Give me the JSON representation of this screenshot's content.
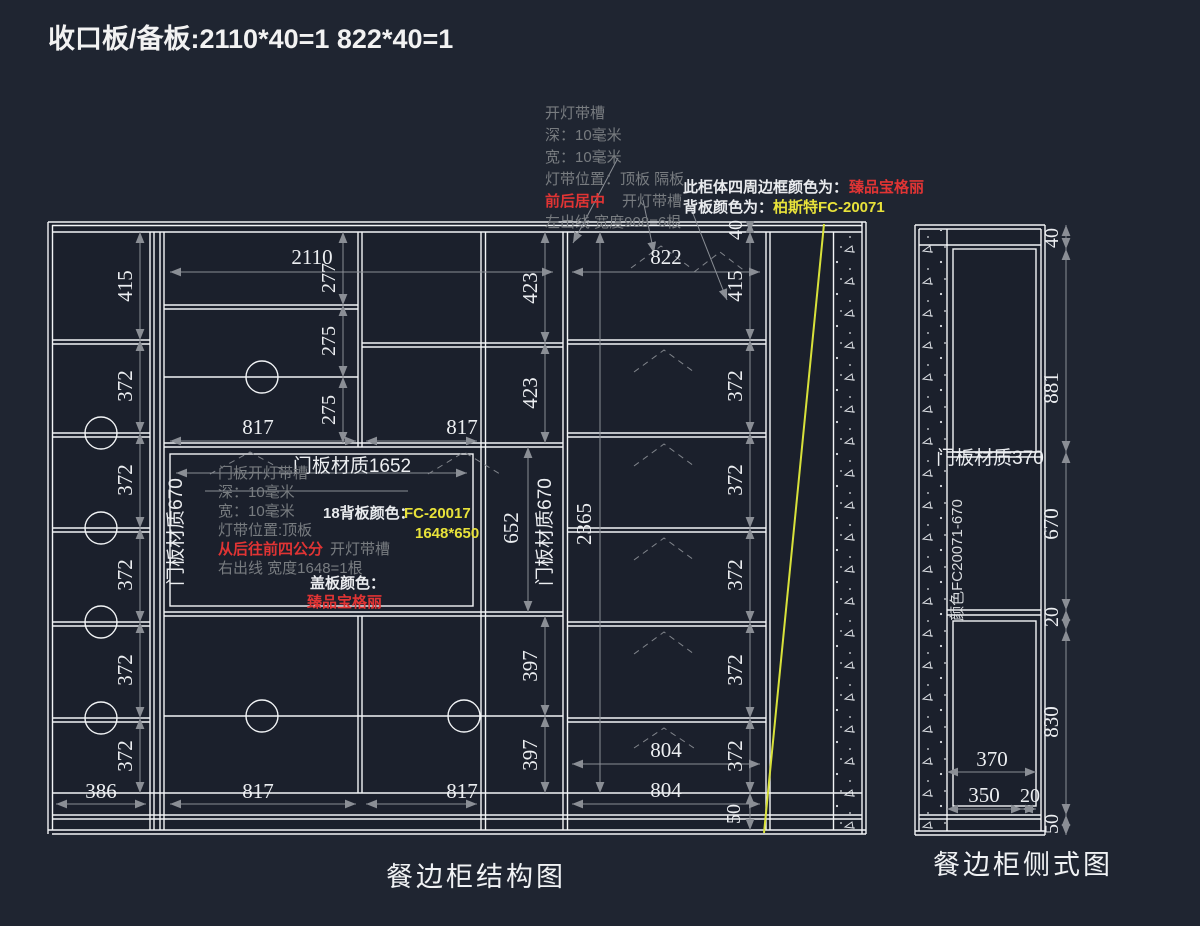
{
  "window": {
    "title_note": "收口板/备板:2110*40=1  822*40=1"
  },
  "colors": {
    "background": "#1f2531",
    "drawing_line": "#f2f4f6",
    "dim_line": "#8a8e95",
    "dim_text": "#eceef1",
    "note_gray": "#787c80",
    "note_red": "#e03434",
    "note_yellow": "#e8e23a",
    "diagonal_line_yellow": "#d8e13a"
  },
  "top_notes": {
    "line1": "开灯带槽",
    "line2": "深：10毫米",
    "line3": "宽：10毫米",
    "line4": "灯带位置：顶板  隔板",
    "line5_red": "前后居中",
    "line5_gray": "开灯带槽",
    "line6": "左出线  宽度908=6根"
  },
  "frame_notes": {
    "border_label": "此柜体四周边框颜色为：",
    "border_value": "臻品宝格丽",
    "back_label": "背板颜色为：",
    "back_value": "柏斯特FC-20071"
  },
  "door_notes": {
    "line1": "门板开灯带槽",
    "line2": "深：10毫米",
    "line3": "宽：10毫米",
    "line4": "灯带位置:顶板",
    "line5_red": "从后往前四公分",
    "line5_gray": "开灯带槽",
    "line6": "右出线  宽度1648=1根",
    "panel_label": "18背板颜色：",
    "panel_value": "FC-20017",
    "panel_size": "1648*650",
    "cover_label": "盖板颜色：",
    "cover_value": "臻品宝格丽"
  },
  "labels": {
    "door_width": "门板材质1652",
    "door_side": "门板材质670",
    "side_door": "门板材质370",
    "side_color": "颜色FC20071-670",
    "main_caption": "餐边柜结构图",
    "side_caption": "餐边柜侧式图"
  },
  "dims": {
    "d20": "20",
    "d40": "40",
    "d50": "50",
    "d275": "275",
    "d277": "277",
    "d350": "350",
    "d370": "370",
    "d372": "372",
    "d386": "386",
    "d397": "397",
    "d415": "415",
    "d423": "423",
    "d652": "652",
    "d670": "670",
    "d804": "804",
    "d817": "817",
    "d822": "822",
    "d830": "830",
    "d881": "881",
    "d2110": "2110",
    "d2365": "2365"
  },
  "dim_chains": {
    "left_column_heights": [
      "415",
      "372",
      "372",
      "372",
      "372",
      "372"
    ],
    "mid_top_left_heights": [
      "277",
      "275",
      "275"
    ],
    "mid_top_widths": [
      "817",
      "817"
    ],
    "bottom_widths": [
      "386",
      "817",
      "817"
    ],
    "narrow_column_heights": [
      "423",
      "423",
      "652",
      "397",
      "397"
    ],
    "right_column_heights": [
      "40",
      "415",
      "372",
      "372",
      "372",
      "372",
      "372",
      "50"
    ],
    "right_column_widths": [
      "822",
      "804",
      "804"
    ],
    "overall_width": "2110",
    "overall_height": "2365",
    "side_view_heights": [
      "40",
      "881",
      "670",
      "20",
      "830",
      "50"
    ],
    "side_view_widths": [
      "370",
      "350",
      "20"
    ]
  }
}
